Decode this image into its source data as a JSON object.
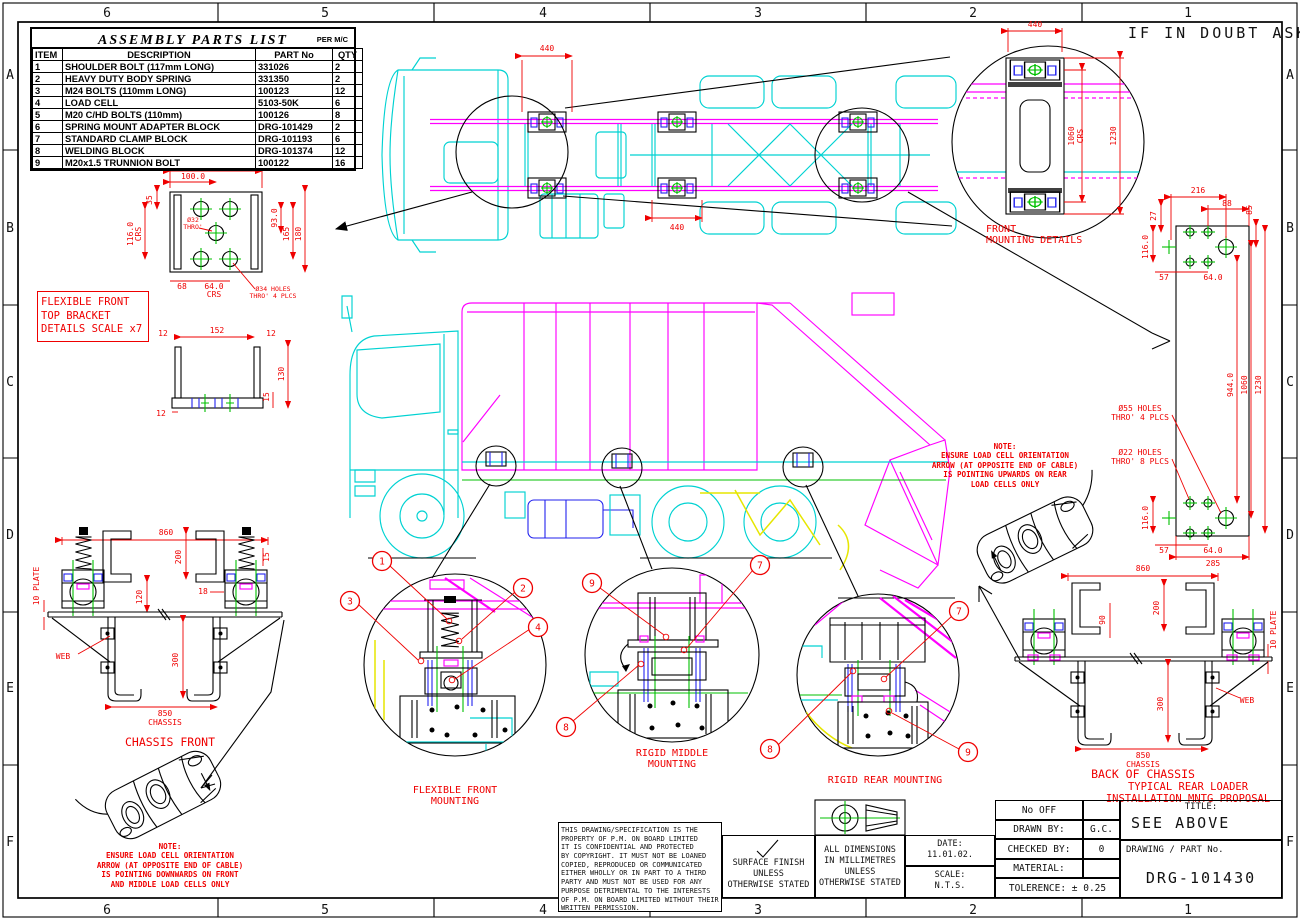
{
  "sheet": {
    "if_in_doubt": "IF IN DOUBT ASK"
  },
  "zones": {
    "cols": [
      "6",
      "5",
      "4",
      "3",
      "2",
      "1"
    ],
    "rows": [
      "A",
      "B",
      "C",
      "D",
      "E",
      "F"
    ]
  },
  "colors": {
    "red": "#ef0000",
    "cyan": "#00d2d2",
    "magenta": "#ff00ff",
    "green": "#00c000",
    "blue": "#2222ee",
    "yellow": "#e6e600"
  },
  "parts_list": {
    "title": "ASSEMBLY PARTS LIST",
    "per": "PER M/C",
    "headers": [
      "ITEM",
      "DESCRIPTION",
      "PART No",
      "QTY"
    ],
    "rows": [
      [
        "1",
        "SHOULDER BOLT (117mm LONG)",
        "331026",
        "2"
      ],
      [
        "2",
        "HEAVY DUTY BODY SPRING",
        "331350",
        "2"
      ],
      [
        "3",
        "M24  BOLTS (110mm LONG)",
        "100123",
        "12"
      ],
      [
        "4",
        "LOAD CELL",
        "5103-50K",
        "6"
      ],
      [
        "5",
        "M20  C/HD BOLTS (110mm)",
        "100126",
        "8"
      ],
      [
        "6",
        "SPRING MOUNT ADAPTER BLOCK",
        "DRG-101429",
        "2"
      ],
      [
        "7",
        "STANDARD CLAMP BLOCK",
        "DRG-101193",
        "6"
      ],
      [
        "8",
        "WELDING BLOCK",
        "DRG-101374",
        "12"
      ],
      [
        "9",
        "M20x1.5 TRUNNION BOLT",
        "100122",
        "16"
      ]
    ]
  },
  "labels": {
    "front_mounting_1": "FRONT",
    "front_mounting_2": "MOUNTING DETAILS",
    "flex_bracket_1": "FLEXIBLE FRONT",
    "flex_bracket_2": "TOP BRACKET",
    "flex_bracket_3": "DETAILS SCALE x7",
    "chassis_front": "CHASSIS FRONT",
    "back_of_chassis": "BACK OF CHASSIS",
    "ffm_1": "FLEXIBLE FRONT",
    "ffm_2": "MOUNTING",
    "rmm_1": "RIGID MIDDLE",
    "rmm_2": "MOUNTING",
    "rrm": "RIGID REAR MOUNTING",
    "typical_1": "TYPICAL REAR LOADER",
    "typical_2": "INSTALLATION MNTG PROPOSAL",
    "web": "WEB"
  },
  "notes": {
    "front": [
      "NOTE:",
      "ENSURE LOAD CELL ORIENTATION",
      "ARROW (AT OPPOSITE END OF CABLE)",
      "IS POINTING DOWNWARDS ON FRONT",
      "AND MIDDLE LOAD CELLS ONLY"
    ],
    "rear": [
      "NOTE:",
      "ENSURE LOAD CELL ORIENTATION",
      "ARROW (AT OPPOSITE END OF CABLE)",
      "IS POINTING UPWARDS ON REAR",
      "LOAD CELLS ONLY"
    ]
  },
  "balloons": {
    "n1": "1",
    "n2": "2",
    "n3": "3",
    "n4": "4",
    "n7": "7",
    "n8": "8",
    "n9": "9"
  },
  "dims": {
    "plan_440a": "440",
    "plan_440b": "440",
    "fmd_440": "440",
    "fmd_1060": "1060",
    "fmd_crs": "CRS",
    "fmd_1230": "1230",
    "plate_216": "216",
    "plate_27": "27",
    "plate_88": "88",
    "plate_85": "85",
    "plate_116t": "116.0",
    "plate_57t": "57",
    "plate_64t": "64.0",
    "plate_944": "944.0",
    "plate_1060": "1060",
    "plate_1230": "1230",
    "plate_116b": "116.0",
    "plate_57b": "57",
    "plate_64b": "64.0",
    "plate_285": "285",
    "plate_h55a": "Ø55 HOLES",
    "plate_h55b": "THRO' 4 PLCS",
    "plate_h22a": "Ø22 HOLES",
    "plate_h22b": "THRO' 8 PLCS",
    "brk_200": "200",
    "brk_100": "100.0",
    "brk_35": "35",
    "brk_116": "116.0",
    "brk_crs1": "CRS",
    "brk_93": "93.0",
    "brk_165": "165",
    "brk_180": "180",
    "brk_d32a": "Ø32",
    "brk_d32b": "THRO'",
    "brk_68": "68",
    "brk_64": "64.0",
    "brk_crs2": "CRS",
    "brk_h34a": "Ø34 HOLES",
    "brk_h34b": "THRO' 4 PLCS",
    "brk_12a": "12",
    "brk_152": "152",
    "brk_12b": "12",
    "brk_130": "130",
    "brk_15": "15",
    "brk_12c": "12",
    "cf_860": "860",
    "cf_200": "200",
    "cf_15": "15",
    "cf_120": "120",
    "cf_18": "18",
    "cf_10plate": "10 PLATE",
    "cf_300": "300",
    "cf_850": "850",
    "cf_chassis": "CHASSIS",
    "bc_860": "860",
    "bc_200": "200",
    "bc_90": "90",
    "bc_10plate": "10 PLATE",
    "bc_300": "300",
    "bc_850": "850",
    "bc_chassis": "CHASSIS"
  },
  "title_block": {
    "no_off": "No OFF",
    "no_off_val": "",
    "drawn_by": "DRAWN BY:",
    "drawn_by_val": "G.C.",
    "checked_by": "CHECKED BY:",
    "checked_by_val": "0",
    "material": "MATERIAL:",
    "material_val": "",
    "tolerance": "TOLERENCE: ± 0.25",
    "title_label": "TITLE:",
    "title_val": "SEE ABOVE",
    "drawing_label": "DRAWING / PART No.",
    "drawing_val": "DRG-101430",
    "date_label": "DATE:",
    "date_val": "11.01.02.",
    "scale_label": "SCALE:",
    "scale_val": "N.T.S.",
    "surface": [
      "SURFACE FINISH",
      "UNLESS",
      "OTHERWISE STATED"
    ],
    "dims_note": [
      "ALL DIMENSIONS",
      "IN MILLIMETRES",
      "UNLESS",
      "OTHERWISE STATED"
    ],
    "disclaimer": [
      "THIS DRAWING/SPECIFICATION IS THE",
      "PROPERTY OF P.M. ON BOARD LIMITED",
      "IT IS CONFIDENTIAL AND PROTECTED",
      "BY COPYRIGHT. IT MUST NOT BE LOANED",
      "COPIED, REPRODUCED OR COMMUNICATED",
      "EITHER WHOLLY OR IN PART TO A THIRD",
      "PARTY AND MUST NOT BE USED FOR ANY",
      "PURPOSE DETRIMENTAL TO THE INTERESTS",
      "OF P.M. ON BOARD LIMITED WITHOUT THEIR",
      "WRITTEN PERMISSION."
    ]
  }
}
